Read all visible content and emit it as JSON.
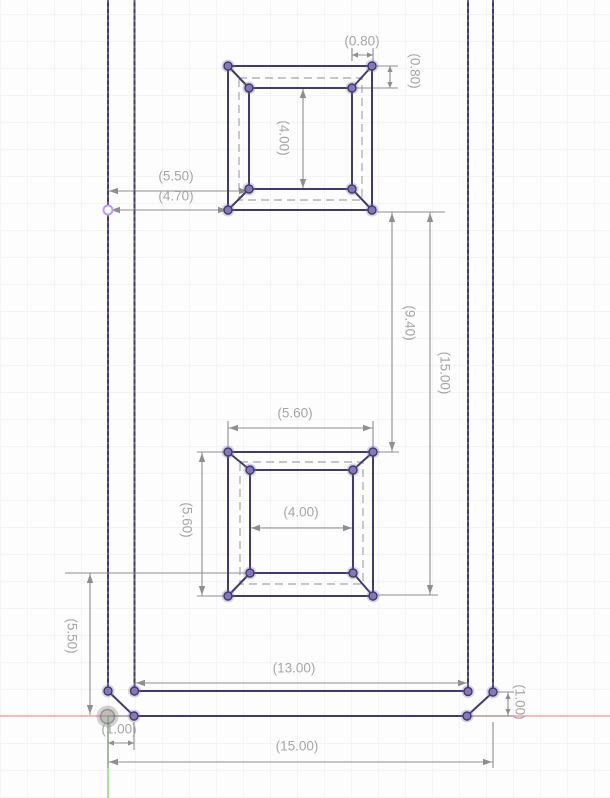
{
  "app": {
    "view_name": "cad-sketch-canvas",
    "description": "2D sketch of a rectangular plate with two chamfered square pockets and reference dimensions"
  },
  "canvas": {
    "width_px": 610,
    "height_px": 798,
    "background_color": "#fdfdfd",
    "grid_color": "#eaeaea",
    "grid_spacing_px": 27
  },
  "axes": {
    "x_axis_color": "#f2a5a5",
    "y_axis_color": "#8fd97f",
    "origin_marker": "origin-point"
  },
  "sketch": {
    "geometry_color": "#403b69",
    "vertex_color": "#8678b8",
    "construction_color": "#b3b3b3",
    "highlight_point_color": "#b89ff0"
  },
  "dimensions": {
    "line_color": "#8f8f8f",
    "text_color": "#a6a6a6",
    "labels": {
      "top_pocket_chamfer_width": "(0.80)",
      "top_pocket_chamfer_height": "(0.80)",
      "top_pocket_inner_height": "(4.00)",
      "edge_to_top_pocket_inner": "(5.50)",
      "edge_to_top_pocket_outer": "(4.70)",
      "pocket_vertical_gap": "(9.40)",
      "pocket_vertical_span": "(15.00)",
      "bottom_pocket_outer_width": "(5.60)",
      "bottom_pocket_outer_height": "(5.60)",
      "bottom_pocket_inner_width": "(4.00)",
      "bottom_edge_to_pocket": "(5.50)",
      "part_inner_width": "(13.00)",
      "corner_chamfer_width": "(1.00)",
      "corner_chamfer_height": "(1.00)",
      "part_outer_width": "(15.00)"
    }
  }
}
